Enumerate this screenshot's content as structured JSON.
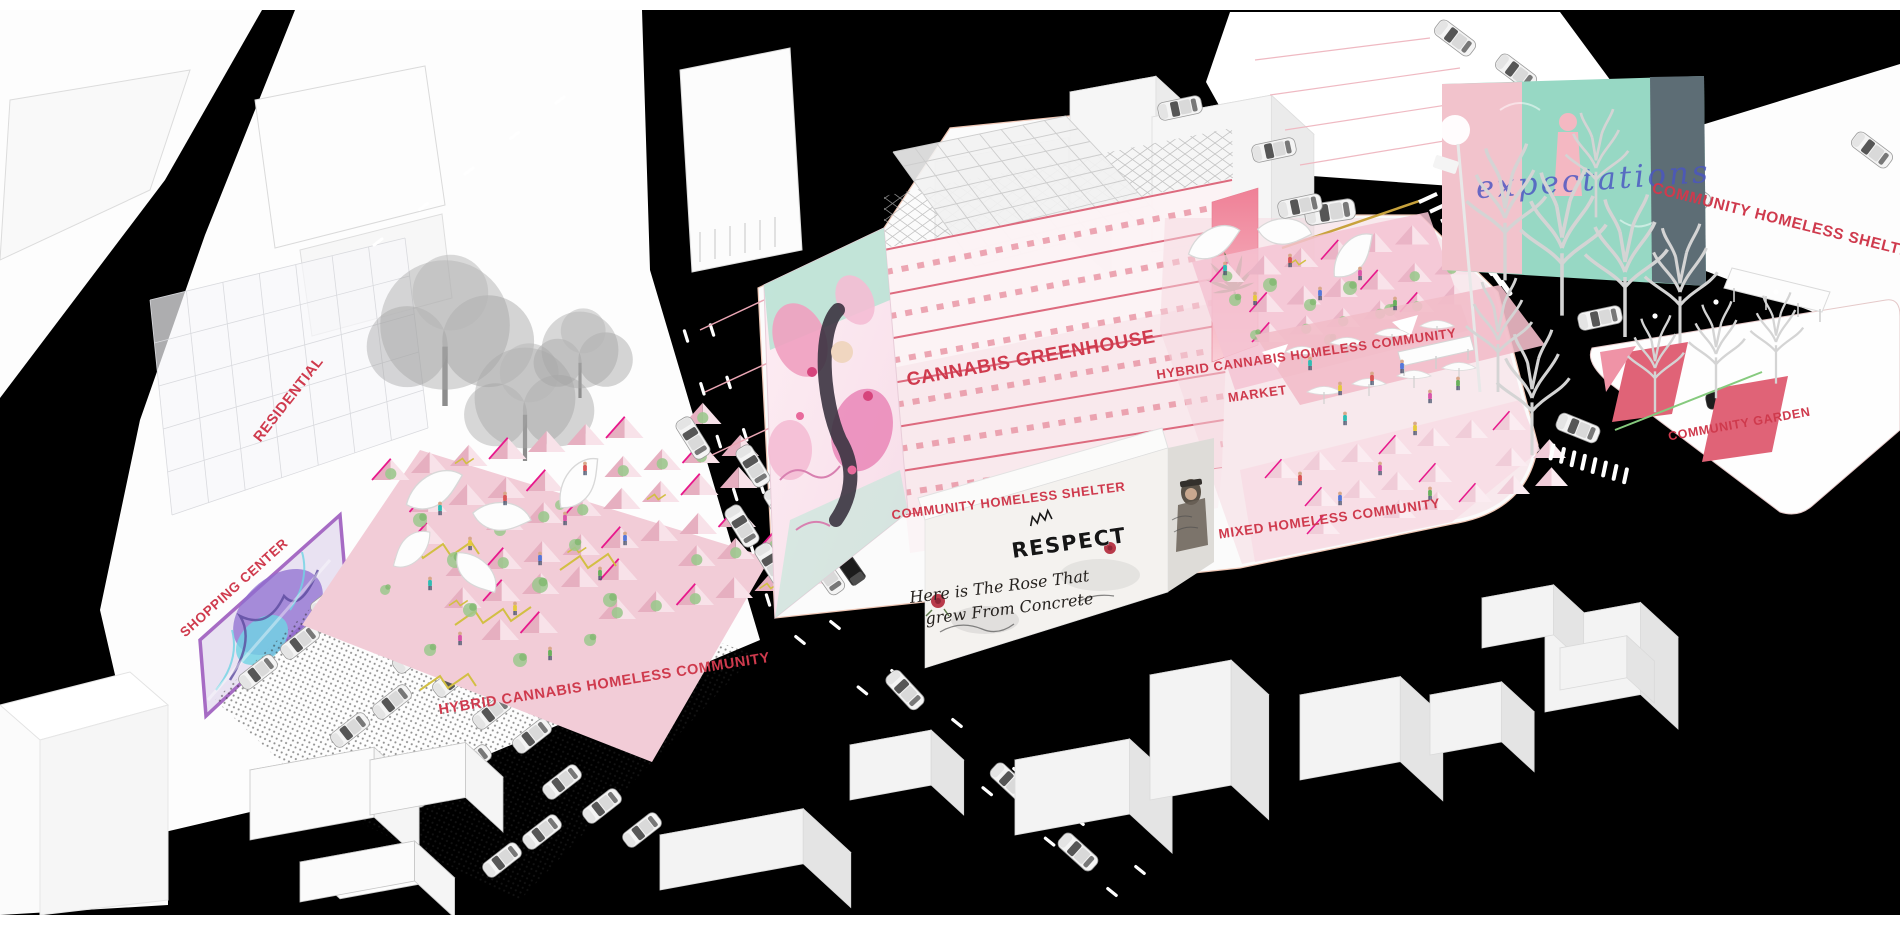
{
  "labels": {
    "residential": "RESIDENTIAL",
    "shopping_center": "SHOPPING CENTER",
    "hybrid_community_left": "HYBRID CANNABIS HOMELESS COMMUNITY",
    "cannabis_greenhouse": "CANNABIS GREENHOUSE",
    "community_homeless_shelter": "COMMUNITY HOMELESS SHELTER",
    "hybrid_community_right": "HYBRID CANNABIS HOMELESS COMMUNITY",
    "market": "MARKET",
    "mixed_homeless_community": "MIXED HOMELESS COMMUNITY",
    "community_homeless_shelter_right": "COMMUNITY HOMELESS SHELTER",
    "community_garden": "COMMUNITY GARDEN"
  },
  "graffiti": {
    "respect": "RESPECT",
    "rose_poem_line1": "Here is The Rose That",
    "rose_poem_line2": "grew From Concrete",
    "mural_script": "expectations"
  },
  "palette": {
    "label_red": "#cf3a4d",
    "street_black": "#000000",
    "tent_pink": "#f2ccd7",
    "tent_pink_dark": "#e6afc0",
    "tent_pink_light": "#f8e2e9",
    "magenta_accent": "#e8188c",
    "truss_pink": "#dd6a7e",
    "banner_pink": "#ef8c9e",
    "cannabis_green": "#497840",
    "plant_green": "#9cc88e",
    "mural_teal": "#97d8c4",
    "mural_violet": "#8e6ed0",
    "mural_cyan": "#6fd4e4"
  }
}
